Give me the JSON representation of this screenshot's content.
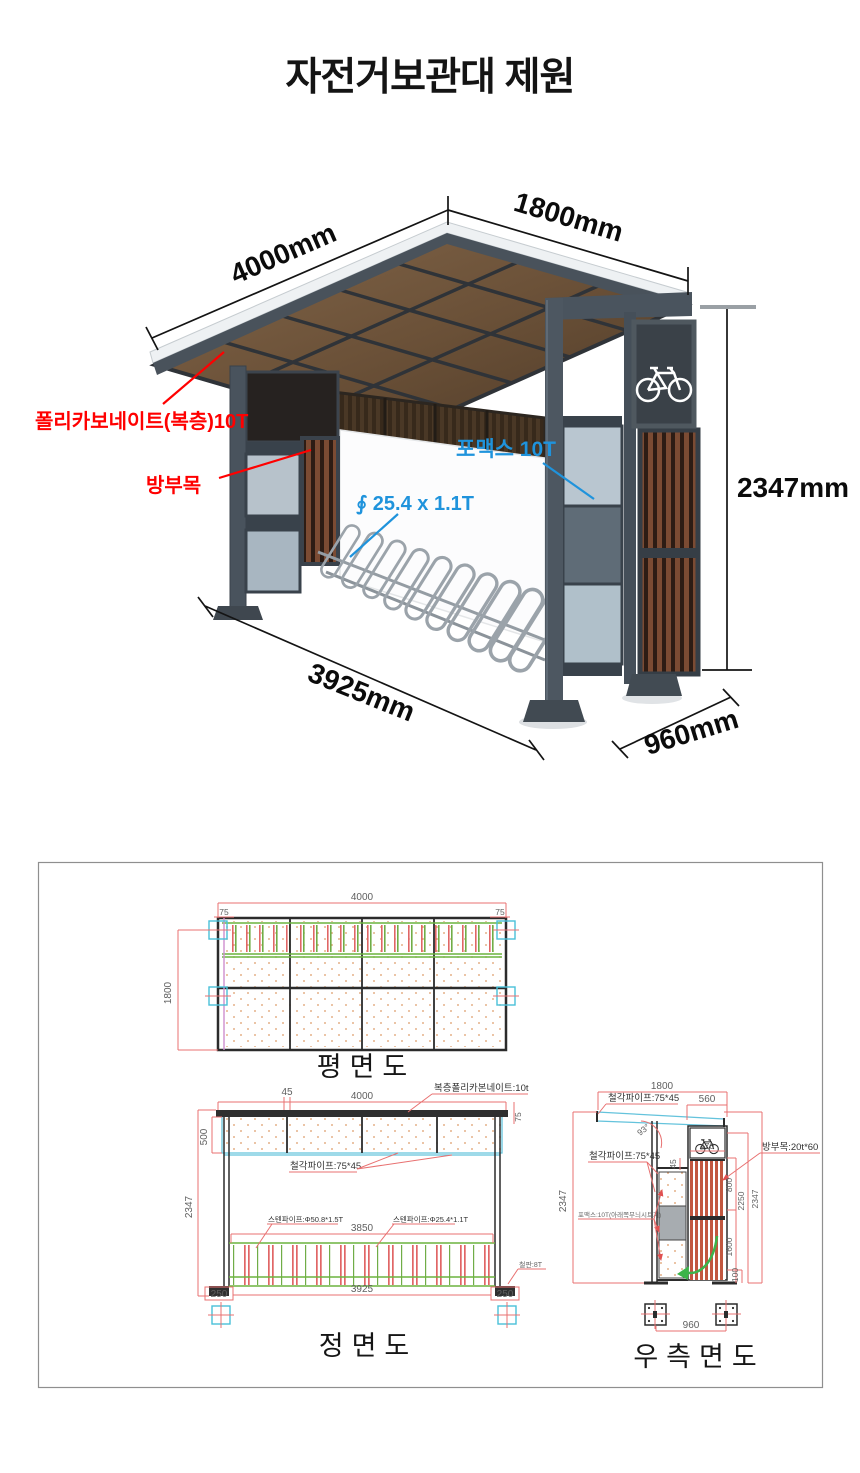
{
  "title": "자전거보관대 제원",
  "photo": {
    "dims": {
      "width": "4000mm",
      "depth": "1800mm",
      "height": "2347mm",
      "length": "3925mm",
      "base": "960mm"
    },
    "labels": {
      "polycarbonate": "폴리카보네이트(복층)10T",
      "wood": "방부목",
      "fomex": "포맥스 10T",
      "pipe": "∮ 25.4 x 1.1T"
    },
    "colors": {
      "red_label": "#ff0000",
      "blue_label": "#1f93dc"
    }
  },
  "plan": {
    "title": "평면도",
    "dims": {
      "top": "4000",
      "left": "1800",
      "corner_left": "75",
      "corner_right": "75"
    }
  },
  "front": {
    "title": "정면도",
    "dims": {
      "offset45": "45",
      "top": "4000",
      "roof_thickness": "75",
      "roof_height": "500",
      "height": "2347",
      "rack_span": "3850",
      "span": "3925",
      "base_left": "250",
      "base_right": "250"
    },
    "labels": {
      "roof": "복층폴리카본네이트:10t",
      "frame": "철각파이프:75*45",
      "pipe_large": "스텐파이프:Φ50.8*1.5T",
      "pipe_small": "스텐파이프:Φ25.4*1.1T",
      "plate": "철판:8T"
    }
  },
  "side": {
    "title": "우측면도",
    "dims": {
      "top": "1800",
      "roof_right": "560",
      "angle": "93°",
      "icon_width": "470",
      "gap45": "45",
      "h800": "800",
      "h2250": "2250",
      "h1600": "1600",
      "height_left": "2347",
      "height_right": "2347",
      "h100": "100",
      "base": "960"
    },
    "labels": {
      "frame_top": "철각파이프:75*45",
      "frame_left": "철각파이프:75*45",
      "wood": "방부목:20t*60",
      "fomex": "포맥스:10T(아래쪽무늬시트지)"
    }
  },
  "cad_colors": {
    "dimension": "#e87070",
    "structure": "#2b2b2b",
    "pipe_green": "#6cb33f",
    "panel_cyan": "#64c3dc",
    "plate_cyan": "#49c0d8",
    "dots": "#dd9a66"
  }
}
